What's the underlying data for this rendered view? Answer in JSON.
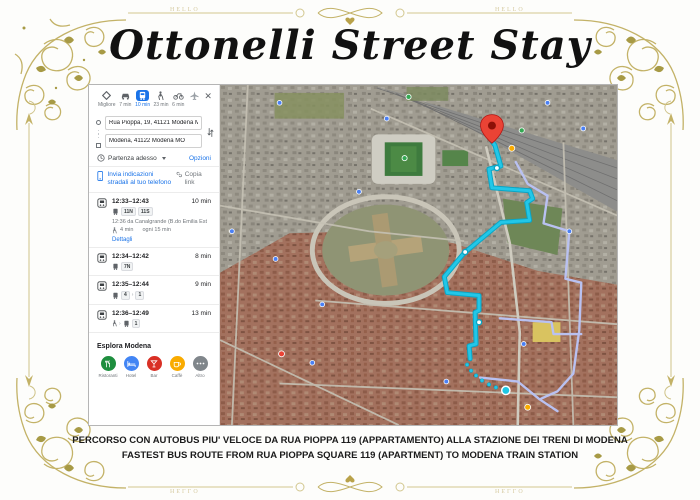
{
  "page": {
    "title": "Ottonelli Street Stay",
    "caption_line1": "PERCORSO CON AUTOBUS PIU' VELOCE DA RUA PIOPPA 119 (APPARTAMENTO) ALLA STAZIONE DEI TRENI DI MODENA",
    "caption_line2": "FASTEST BUS ROUTE FROM RUA PIOPPA SQUARE 119 (APARTMENT) TO MODENA TRAIN STATION",
    "border_text": "HELLO",
    "frame_color": "#c3b267"
  },
  "maps_panel": {
    "modes": [
      {
        "label": "Migliore",
        "icon": "best-route-icon",
        "selected": false
      },
      {
        "label": "7 min",
        "icon": "car-icon",
        "selected": false
      },
      {
        "label": "10 min",
        "icon": "bus-icon",
        "selected": true
      },
      {
        "label": "23 min",
        "icon": "walk-icon",
        "selected": false
      },
      {
        "label": "6 min",
        "icon": "bike-icon",
        "selected": false
      },
      {
        "label": "",
        "icon": "flight-icon",
        "selected": false
      }
    ],
    "close_label": "✕",
    "origin_value": "Rua Pioppa, 19, 41121 Modena MO",
    "destination_value": "Modena, 41122 Modena MO",
    "departure_label": "Partenza adesso",
    "options_label": "Opzioni",
    "send_label": "Invia indicazioni stradali al tuo telefono",
    "copy_label": "Copia link",
    "routes": [
      {
        "times": "12:33–12:43",
        "duration": "10 min",
        "line1": "11N",
        "line2": "11S",
        "departure_info": "12:36 da Canalgrande (B.do Emilia Est",
        "walk_info": "4 min",
        "frequency": "ogni 15 min",
        "details_label": "Dettagli"
      },
      {
        "times": "12:34–12:42",
        "duration": "8 min",
        "line1": "7N"
      },
      {
        "times": "12:35–12:44",
        "duration": "9 min",
        "line1": "4",
        "line2": "1"
      },
      {
        "times": "12:36–12:49",
        "duration": "13 min",
        "line1": "1"
      }
    ],
    "explore": {
      "title": "Esplora Modena",
      "items": [
        {
          "label": "Ristoranti",
          "color": "#1e8e3e"
        },
        {
          "label": "Hotel",
          "color": "#4285f4"
        },
        {
          "label": "Bar",
          "color": "#d93025"
        },
        {
          "label": "Caffè",
          "color": "#f9ab00"
        },
        {
          "label": "Altro",
          "color": "#80868b"
        }
      ]
    }
  },
  "map": {
    "type": "satellite",
    "destination": "Modena train station (red pin)",
    "origin": "Rua Pioppa 119 (cyan dot)",
    "route_color": "#22c7e8",
    "alt_route_color": "#b9c1f1",
    "destination_pin_color": "#ea4335"
  }
}
